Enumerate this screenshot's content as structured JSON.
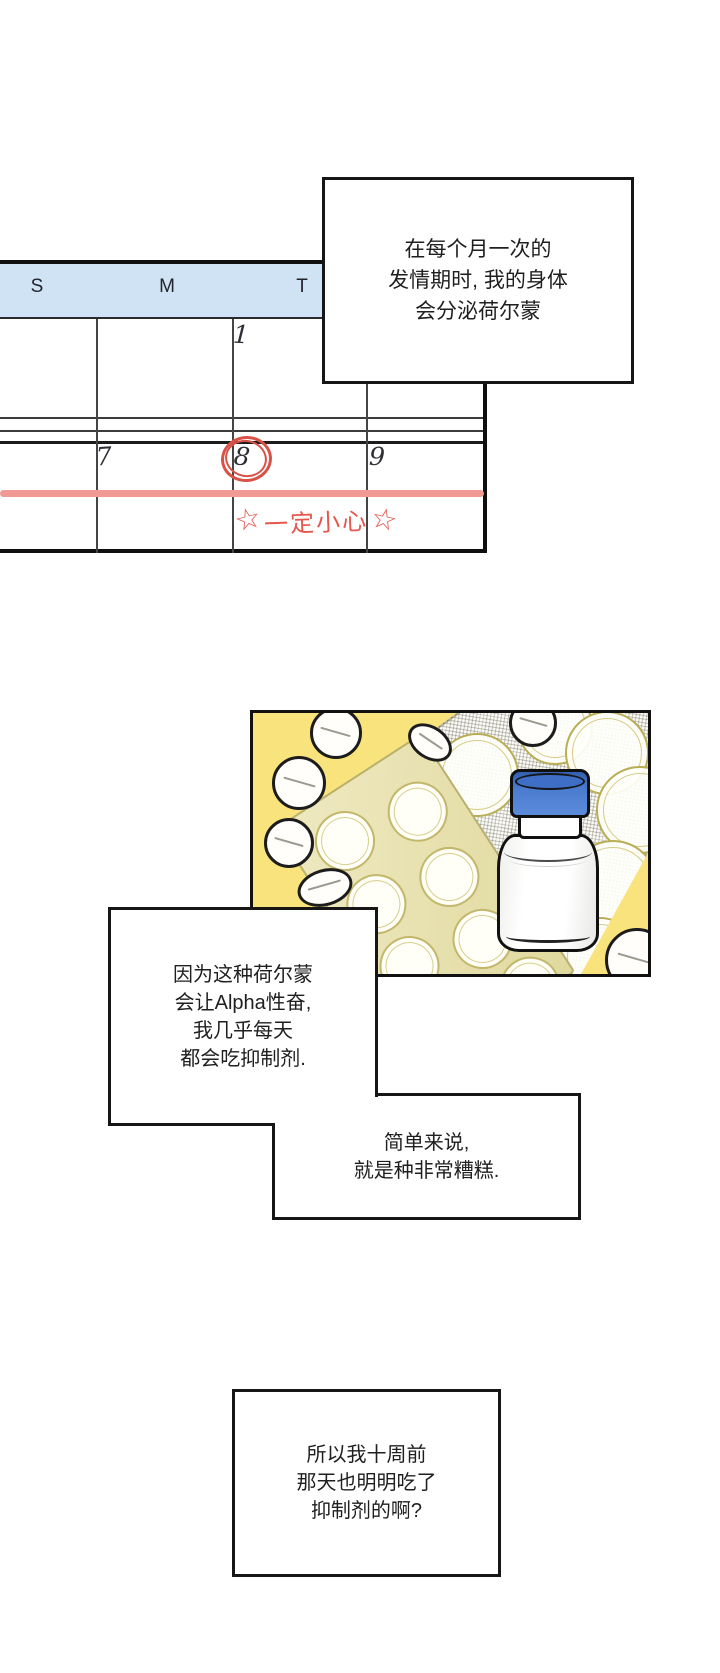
{
  "page": {
    "type": "webtoon comic page",
    "background": "#ffffff"
  },
  "narration": {
    "box1": {
      "line1": "在每个月一次的",
      "line2": "发情期时, 我的身体",
      "line3": "会分泌荷尔蒙"
    },
    "box2": {
      "line1": "因为这种荷尔蒙",
      "line2": "会让Alpha性奋,",
      "line3": "我几乎每天",
      "line4": "都会吃抑制剂."
    },
    "box3": {
      "line1": "简单来说,",
      "line2": "就是种非常糟糕."
    },
    "box4": {
      "line1": "所以我十周前",
      "line2": "那天也明明吃了",
      "line3": "抑制剂的啊?"
    }
  },
  "calendar": {
    "day_headers": {
      "sun": "S",
      "mon": "M",
      "tue": "T"
    },
    "dates": {
      "first": "1",
      "seventh": "7",
      "eighth": "8",
      "ninth": "9"
    },
    "circled_date": "8",
    "annotation": {
      "star": "☆",
      "text": "一定小心"
    },
    "colors": {
      "header_bg": "#cfe3f4",
      "grid_ink": "#3c3c3c",
      "highlight_band": "#f09a93",
      "annotation_red": "#e4574d"
    }
  },
  "illustration": {
    "description": "white pill bottle with blue cap, blister packs and scattered white tablets on a yellow panel with screentone",
    "items": [
      "pill-bottle",
      "blister-pack",
      "screentone-blister-sheet",
      "loose-pills"
    ],
    "colors": {
      "panel_yellow": "#f8e37d",
      "cap_blue": "#4a7ccf",
      "blister_olive": "#e7e0a8",
      "outline_ink": "#111111"
    }
  }
}
